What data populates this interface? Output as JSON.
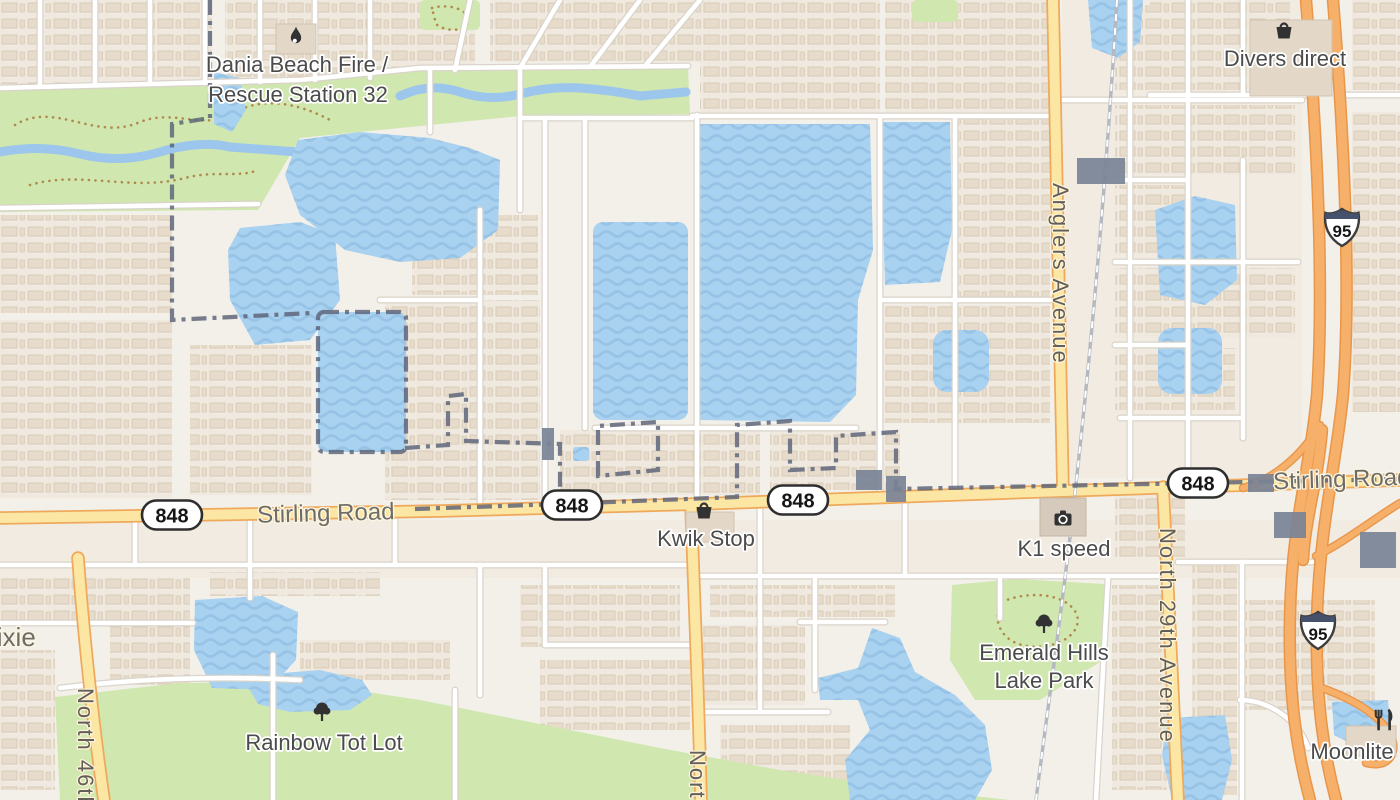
{
  "map": {
    "pois": [
      {
        "name": "Dania Beach Fire / Rescue Station 32",
        "line1": "Dania Beach Fire /",
        "line2": "Rescue Station 32",
        "icon": "fire-icon"
      },
      {
        "name": "Divers direct",
        "line1": "Divers direct",
        "icon": "shopping-bag-icon"
      },
      {
        "name": "Kwik Stop",
        "line1": "Kwik Stop",
        "icon": "shopping-bag-icon"
      },
      {
        "name": "K1 speed",
        "line1": "K1 speed",
        "icon": "camera-icon"
      },
      {
        "name": "Emerald Hills Lake Park",
        "line1": "Emerald Hills",
        "line2": "Lake Park",
        "icon": "tree-icon"
      },
      {
        "name": "Rainbow Tot Lot",
        "line1": "Rainbow Tot Lot",
        "icon": "tree-icon"
      },
      {
        "name": "Moonlite",
        "line1": "Moonlite",
        "icon": "restaurant-icon"
      }
    ],
    "roads": {
      "stirling_road": "Stirling Road",
      "anglers_avenue": "Anglers Avenue",
      "north_29th_avenue": "North 29th Avenue",
      "north_46th": "North 46th",
      "dixie": "Dixie",
      "north_partial": "North"
    },
    "shields": {
      "route_848": "848",
      "interstate_95": "95"
    },
    "colors": {
      "land": "#f3f0e9",
      "water": "#a9d1f0",
      "park_green": "#d0e7b0",
      "minor_road": "#ffffff",
      "secondary_road_fill": "#fbe7a3",
      "secondary_road_casing": "#efa95c",
      "motorway_fill": "#f6b06a",
      "motorway_casing": "#e8964a",
      "boundary": "#5a6178",
      "poi_label": "#4b4b4b",
      "road_label": "#6e6c66"
    }
  }
}
